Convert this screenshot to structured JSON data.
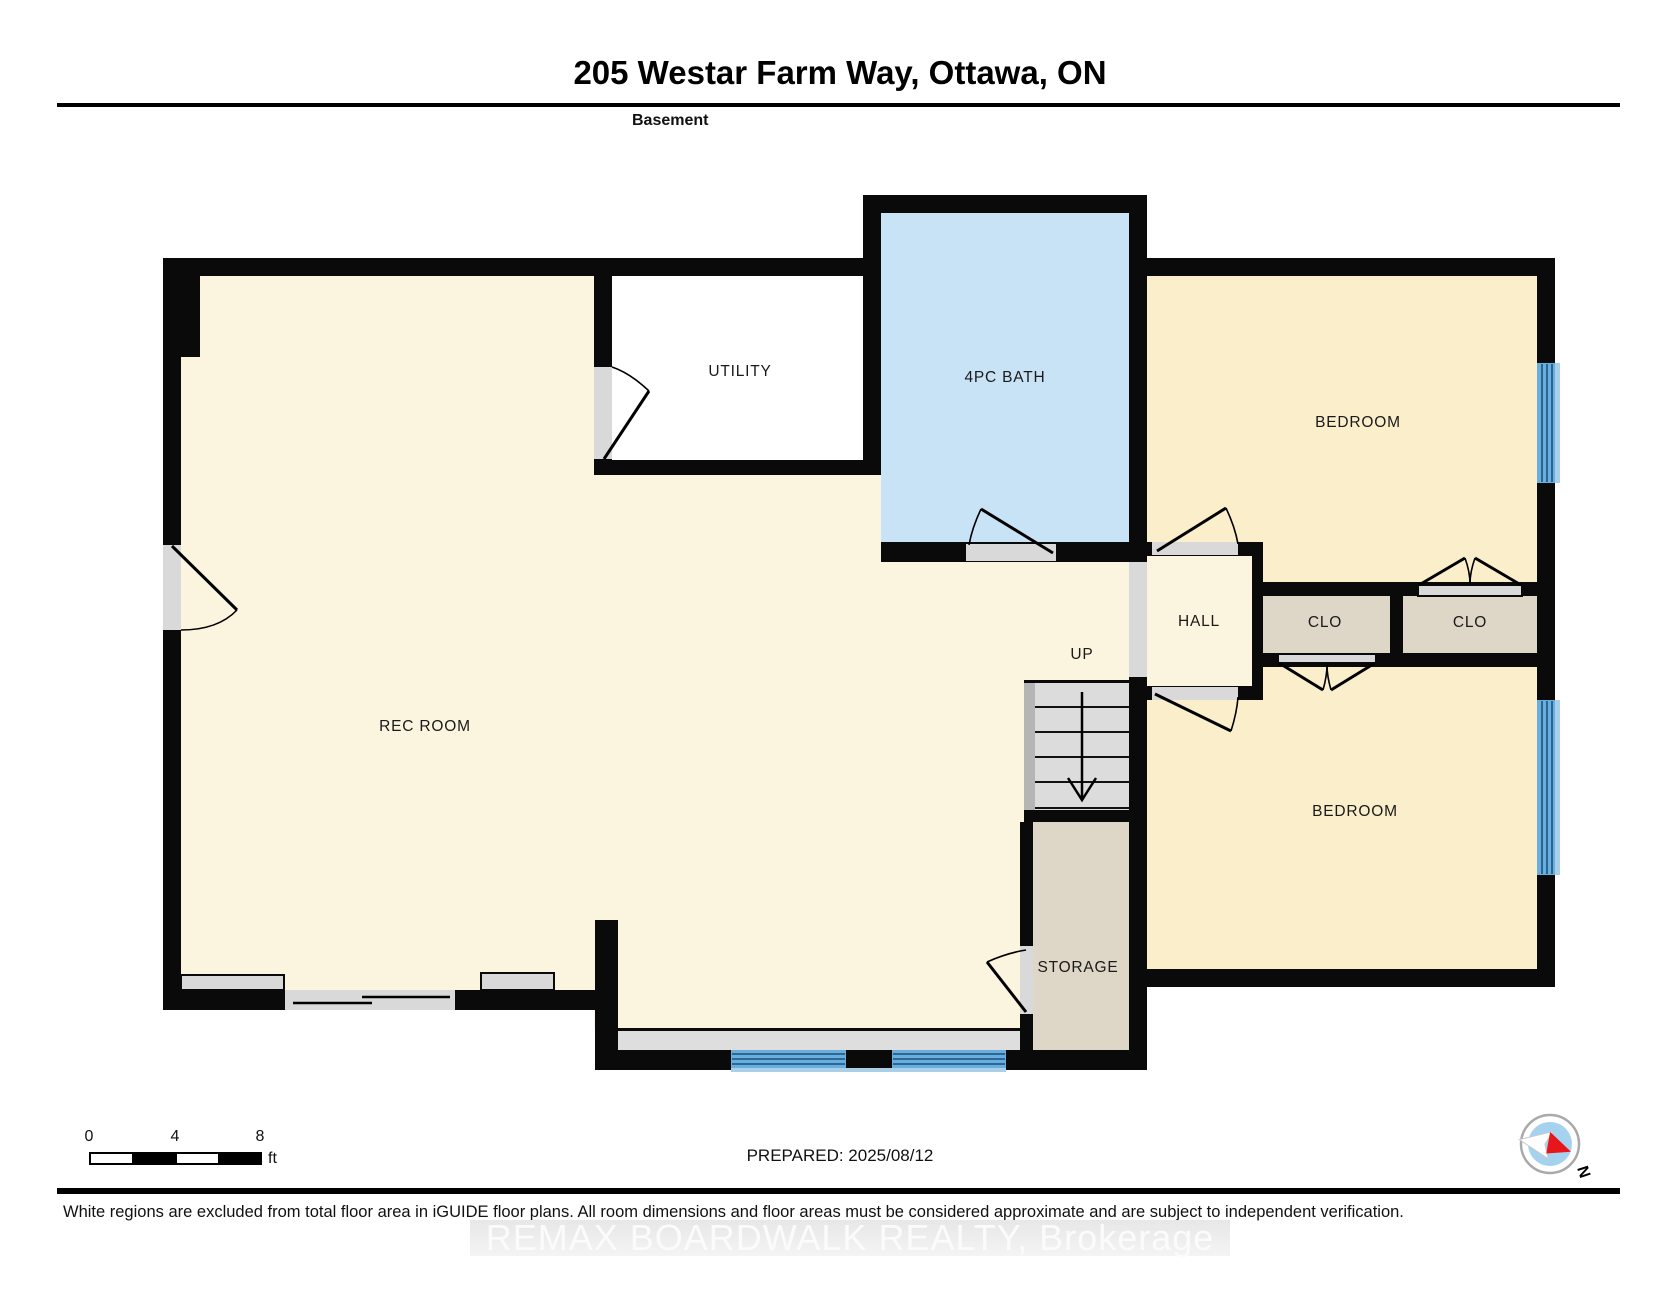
{
  "header": {
    "title": "205 Westar Farm Way, Ottawa, ON",
    "floor": "Basement"
  },
  "rooms": [
    {
      "id": "rec-room",
      "label": "REC ROOM"
    },
    {
      "id": "utility",
      "label": "UTILITY"
    },
    {
      "id": "bath",
      "label": "4PC BATH"
    },
    {
      "id": "bedroom-1",
      "label": "BEDROOM"
    },
    {
      "id": "hall",
      "label": "HALL"
    },
    {
      "id": "closet-1",
      "label": "CLO"
    },
    {
      "id": "closet-2",
      "label": "CLO"
    },
    {
      "id": "bedroom-2",
      "label": "BEDROOM"
    },
    {
      "id": "storage",
      "label": "STORAGE"
    },
    {
      "id": "stairs",
      "label": "UP"
    }
  ],
  "scale_bar": {
    "tick_0": "0",
    "tick_4": "4",
    "tick_8": "8",
    "unit": "ft"
  },
  "compass": {
    "north": "N"
  },
  "footer": {
    "prepared": "PREPARED: 2025/08/12",
    "disclaimer": "White regions are excluded from total floor area in iGUIDE floor plans. All room dimensions and floor areas must be considered approximate and are subject to independent verification.",
    "watermark": "REMAX BOARDWALK REALTY, Brokerage"
  },
  "colors": {
    "wall": "#0a0a0a",
    "living_cream": "#fbf4de",
    "bedroom_beige": "#faeecb",
    "bath_blue": "#c9e3f6",
    "closet_tan": "#ded6c7",
    "utility_white": "#ffffff",
    "window_blue": "#69aedc",
    "door_gray": "#d9d9d9",
    "compass_red": "#e8151b"
  }
}
